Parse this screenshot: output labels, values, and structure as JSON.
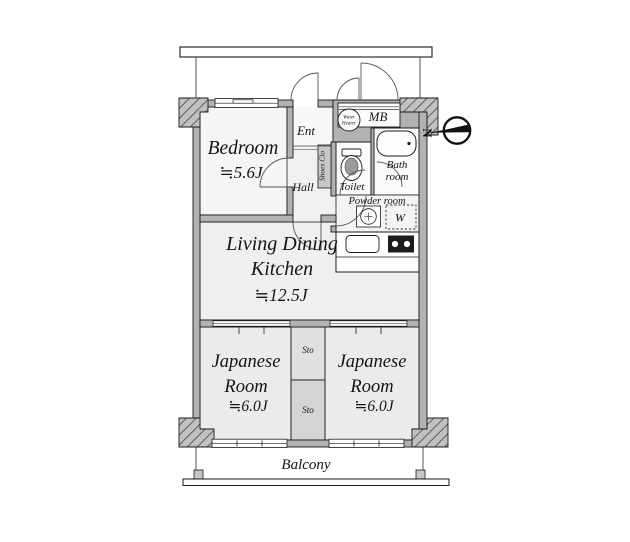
{
  "fp": {
    "bedroom": {
      "name": "Bedroom",
      "size": "≒5.6J"
    },
    "ldk": {
      "line1": "Living Dining",
      "line2": "Kitchen",
      "size": "≒12.5J"
    },
    "jp_left": {
      "line1": "Japanese",
      "line2": "Room",
      "size": "≒6.0J"
    },
    "jp_right": {
      "line1": "Japanese",
      "line2": "Room",
      "size": "≒6.0J"
    },
    "ent": "Ent",
    "hall": "Hall",
    "shoes": "Shoes Clo",
    "toilet": "Toilet",
    "bath": {
      "line1": "Bath",
      "line2": "room"
    },
    "powder": "Powder room",
    "mb": "MB",
    "water_heater": {
      "line1": "Water",
      "line2": "Heater"
    },
    "washer": "W",
    "sto_upper": "Sto",
    "sto_lower": "Sto",
    "balcony": "Balcony",
    "north": "N"
  },
  "colors": {
    "wall": "#b3b2b0",
    "hatch_base": "#c2c1bf",
    "room_light": "#f5f5f3",
    "room_mid": "#efefed",
    "room_tatami": "#ebebe9",
    "storage_upper": "#e0e0de",
    "storage_lower": "#d4d4d2",
    "fixture_white": "#fcfcfb",
    "outline": "#1a1a1a"
  }
}
